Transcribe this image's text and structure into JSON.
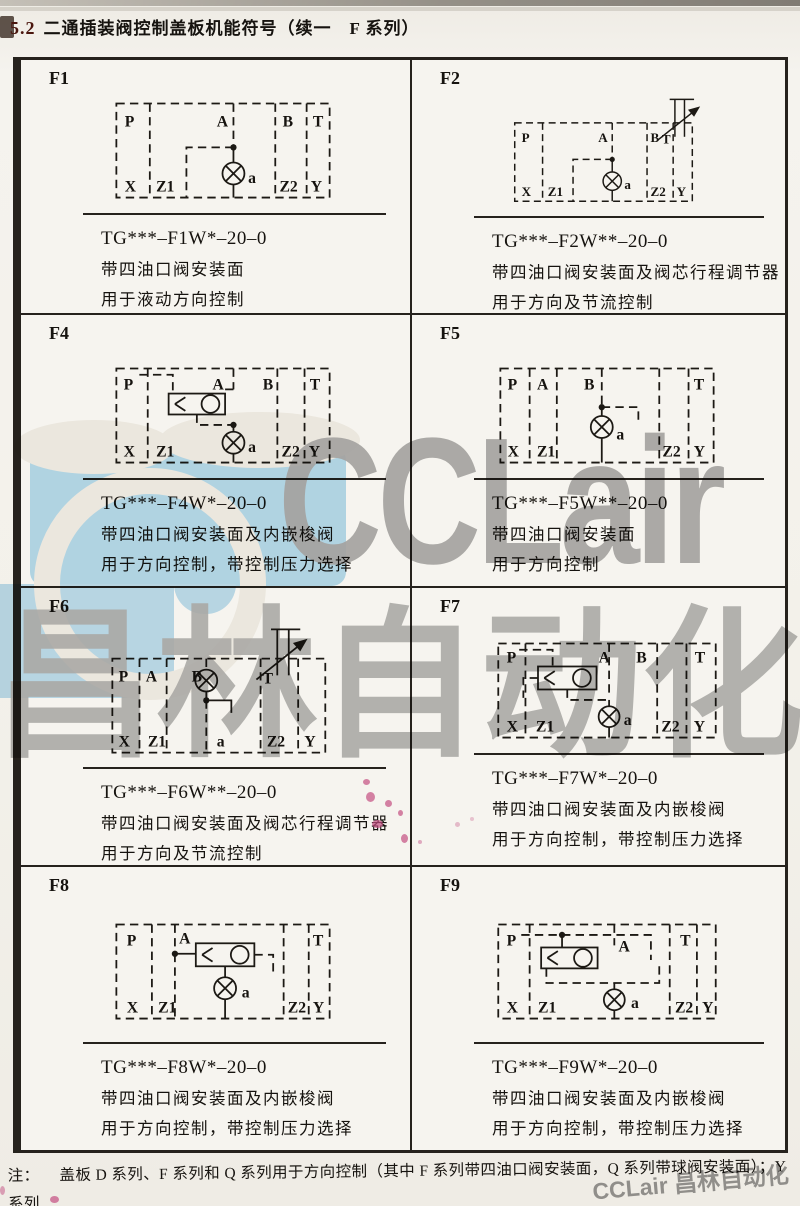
{
  "page": {
    "title_prefix": "5.2",
    "title": "二通插装阀控制盖板机能符号（续一　F 系列）"
  },
  "ports": {
    "P": "P",
    "A": "A",
    "B": "B",
    "T": "T",
    "X": "X",
    "Z1": "Z1",
    "Z2": "Z2",
    "Y": "Y",
    "a": "a"
  },
  "cells": [
    {
      "id": "F1",
      "code": "TG***–F1W*–20–0",
      "desc1": "带四油口阀安装面",
      "desc2": "用于液动方向控制"
    },
    {
      "id": "F2",
      "code": "TG***–F2W**–20–0",
      "desc1": "带四油口阀安装面及阀芯行程调节器",
      "desc2": "用于方向及节流控制"
    },
    {
      "id": "F4",
      "code": "TG***–F4W*–20–0",
      "desc1": "带四油口阀安装面及内嵌梭阀",
      "desc2": "用于方向控制，带控制压力选择"
    },
    {
      "id": "F5",
      "code": "TG***–F5W**–20–0",
      "desc1": "带四油口阀安装面",
      "desc2": "用于方向控制"
    },
    {
      "id": "F6",
      "code": "TG***–F6W**–20–0",
      "desc1": "带四油口阀安装面及阀芯行程调节器",
      "desc2": "用于方向及节流控制"
    },
    {
      "id": "F7",
      "code": "TG***–F7W*–20–0",
      "desc1": "带四油口阀安装面及内嵌梭阀",
      "desc2": "用于方向控制，带控制压力选择"
    },
    {
      "id": "F8",
      "code": "TG***–F8W*–20–0",
      "desc1": "带四油口阀安装面及内嵌梭阀",
      "desc2": "用于方向控制，带控制压力选择"
    },
    {
      "id": "F9",
      "code": "TG***–F9W*–20–0",
      "desc1": "带四油口阀安装面及内嵌梭阀",
      "desc2": "用于方向控制，带控制压力选择"
    }
  ],
  "footnote": {
    "label": "注：",
    "line1": "盖板 D 系列、F 系列和 Q 系列用于方向控制（其中 F 系列带四油口阀安装面，Q 系列带球阀安装面）；Y 系列",
    "line2": "用于压力控制；J 系列用于组成减压控制单元。"
  },
  "watermark": {
    "brand": "CCLair",
    "brand_cn": "昌林自动化",
    "corner": "CCLair 昌林自动化",
    "blue": "#b7ddf1",
    "gray": "#ababab"
  }
}
